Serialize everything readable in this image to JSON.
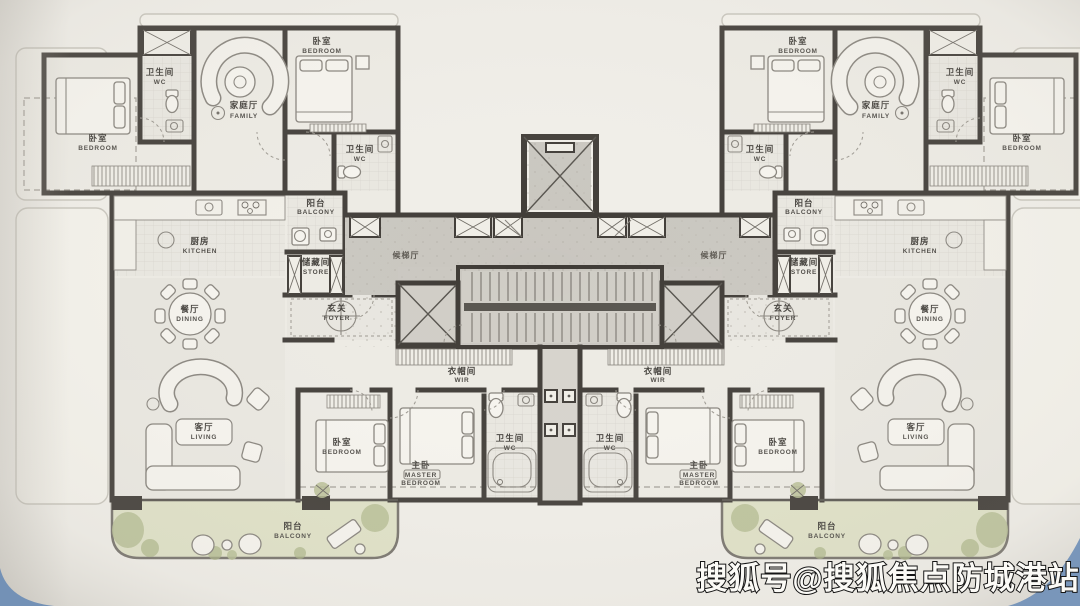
{
  "watermark": {
    "text": "搜狐号@搜狐焦点防城港站"
  },
  "rooms": {
    "bedroom": {
      "zh": "卧室",
      "en": "BEDROOM"
    },
    "master_bedroom": {
      "zh": "主卧",
      "en_line1": "MASTER",
      "en_line2": "BEDROOM"
    },
    "family_room": {
      "zh": "家庭厅",
      "en": "FAMILY"
    },
    "living_room": {
      "zh": "客厅",
      "en": "LIVING"
    },
    "dining_room": {
      "zh": "餐厅",
      "en": "DINING"
    },
    "kitchen": {
      "zh": "厨房",
      "en": "KITCHEN"
    },
    "bathroom": {
      "zh": "卫生间",
      "en": "WC"
    },
    "balcony": {
      "zh": "阳台",
      "en": "BALCONY"
    },
    "store": {
      "zh": "储藏间",
      "en": "STORE"
    },
    "foyer": {
      "zh": "玄关",
      "en": "FOYER"
    },
    "walk_in_robe": {
      "zh": "衣帽间",
      "en": "WIR"
    },
    "elevator_lobby": {
      "zh": "候梯厅"
    }
  },
  "palette": {
    "paper": "#f0eee8",
    "wall": "#3e3a35",
    "corridor_gray": "#c9c6bf",
    "balcony_green": "#dfe1c6",
    "plant_green": "#b6bd93",
    "watermark_blue": "#7795ba",
    "label_text": "#3f3c37"
  }
}
